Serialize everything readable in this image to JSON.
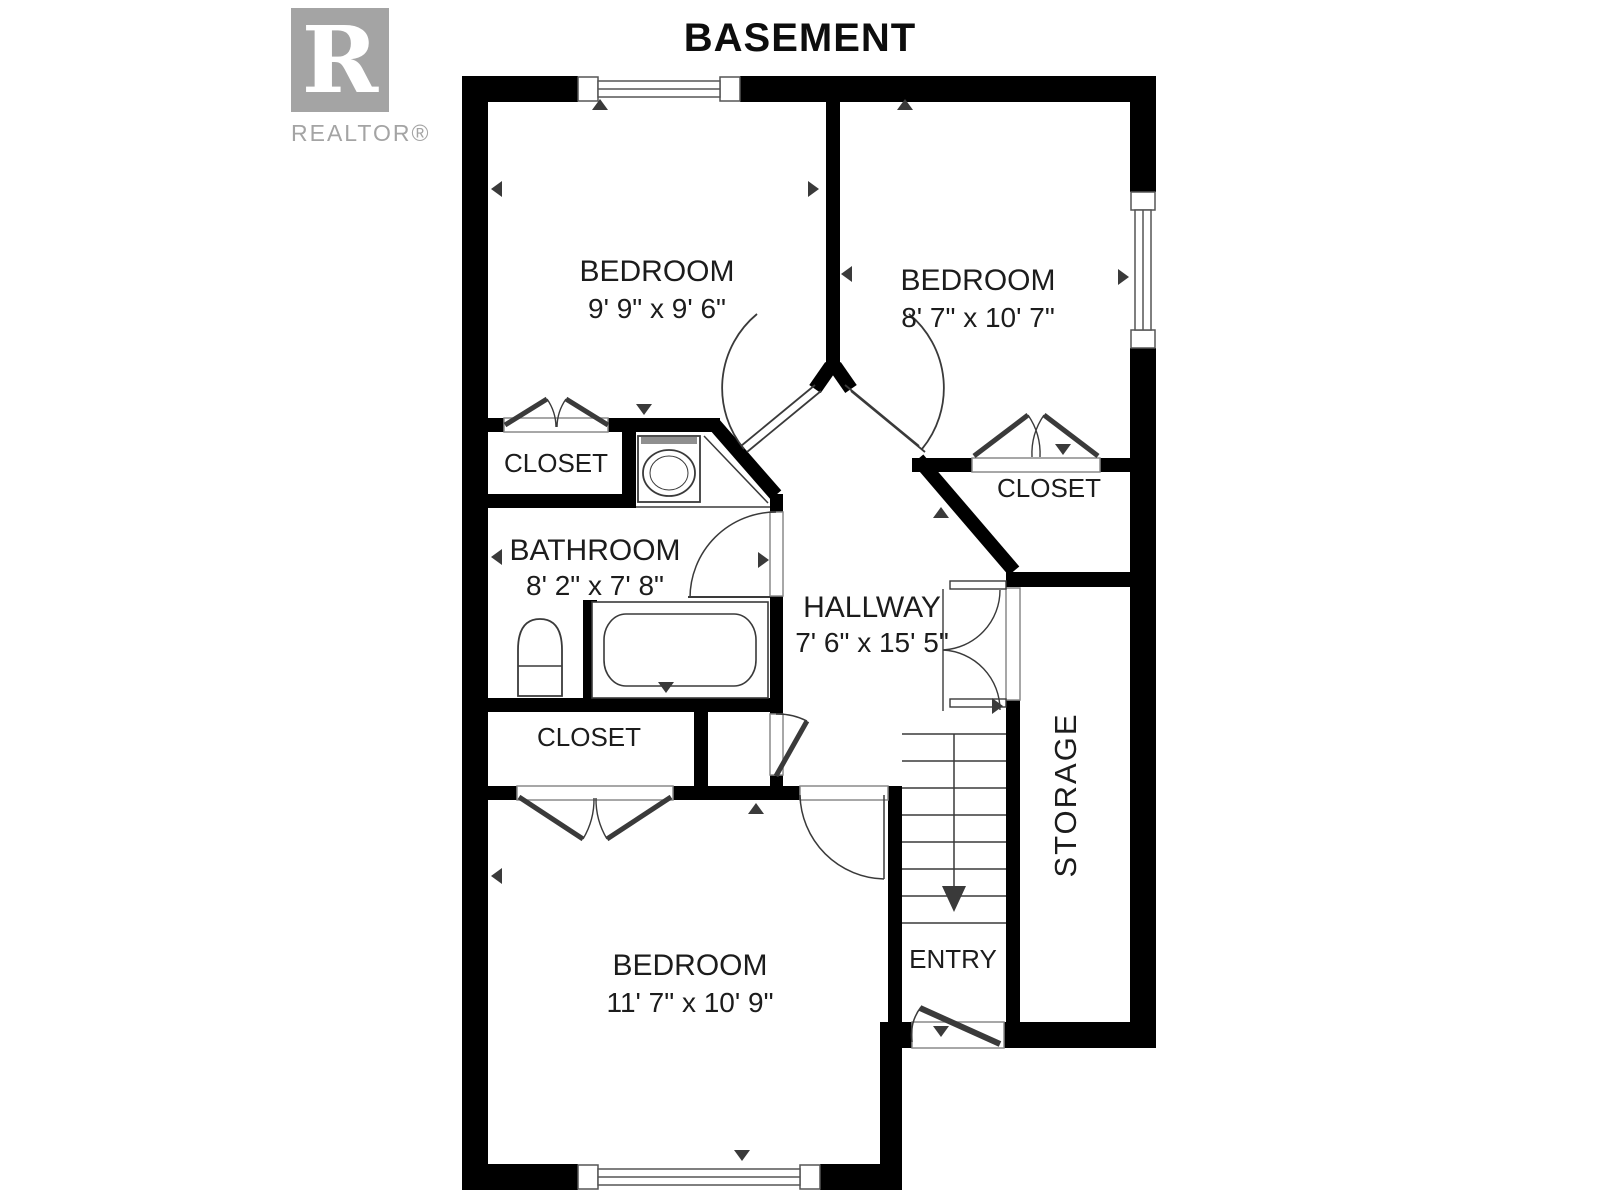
{
  "title": "BASEMENT",
  "logo": {
    "letter": "R",
    "brand": "REALTOR®"
  },
  "rooms": {
    "bedroom1": {
      "name": "BEDROOM",
      "dims": "9' 9\" x 9' 6\""
    },
    "bedroom2": {
      "name": "BEDROOM",
      "dims": "8' 7\" x 10' 7\""
    },
    "bedroom3": {
      "name": "BEDROOM",
      "dims": "11' 7\" x 10' 9\""
    },
    "bathroom": {
      "name": "BATHROOM",
      "dims": "8' 2\" x 7' 8\""
    },
    "hallway": {
      "name": "HALLWAY",
      "dims": "7' 6\" x 15' 5\""
    },
    "closet_upper_left": {
      "name": "CLOSET"
    },
    "closet_upper_right": {
      "name": "CLOSET"
    },
    "closet_lower": {
      "name": "CLOSET"
    },
    "storage": {
      "name": "STORAGE"
    },
    "entry": {
      "name": "ENTRY"
    }
  },
  "colors": {
    "wall": "#000000",
    "line": "#3a3a3a",
    "label": "#1c1c1c",
    "logo_gray": "#a4a4a4"
  }
}
